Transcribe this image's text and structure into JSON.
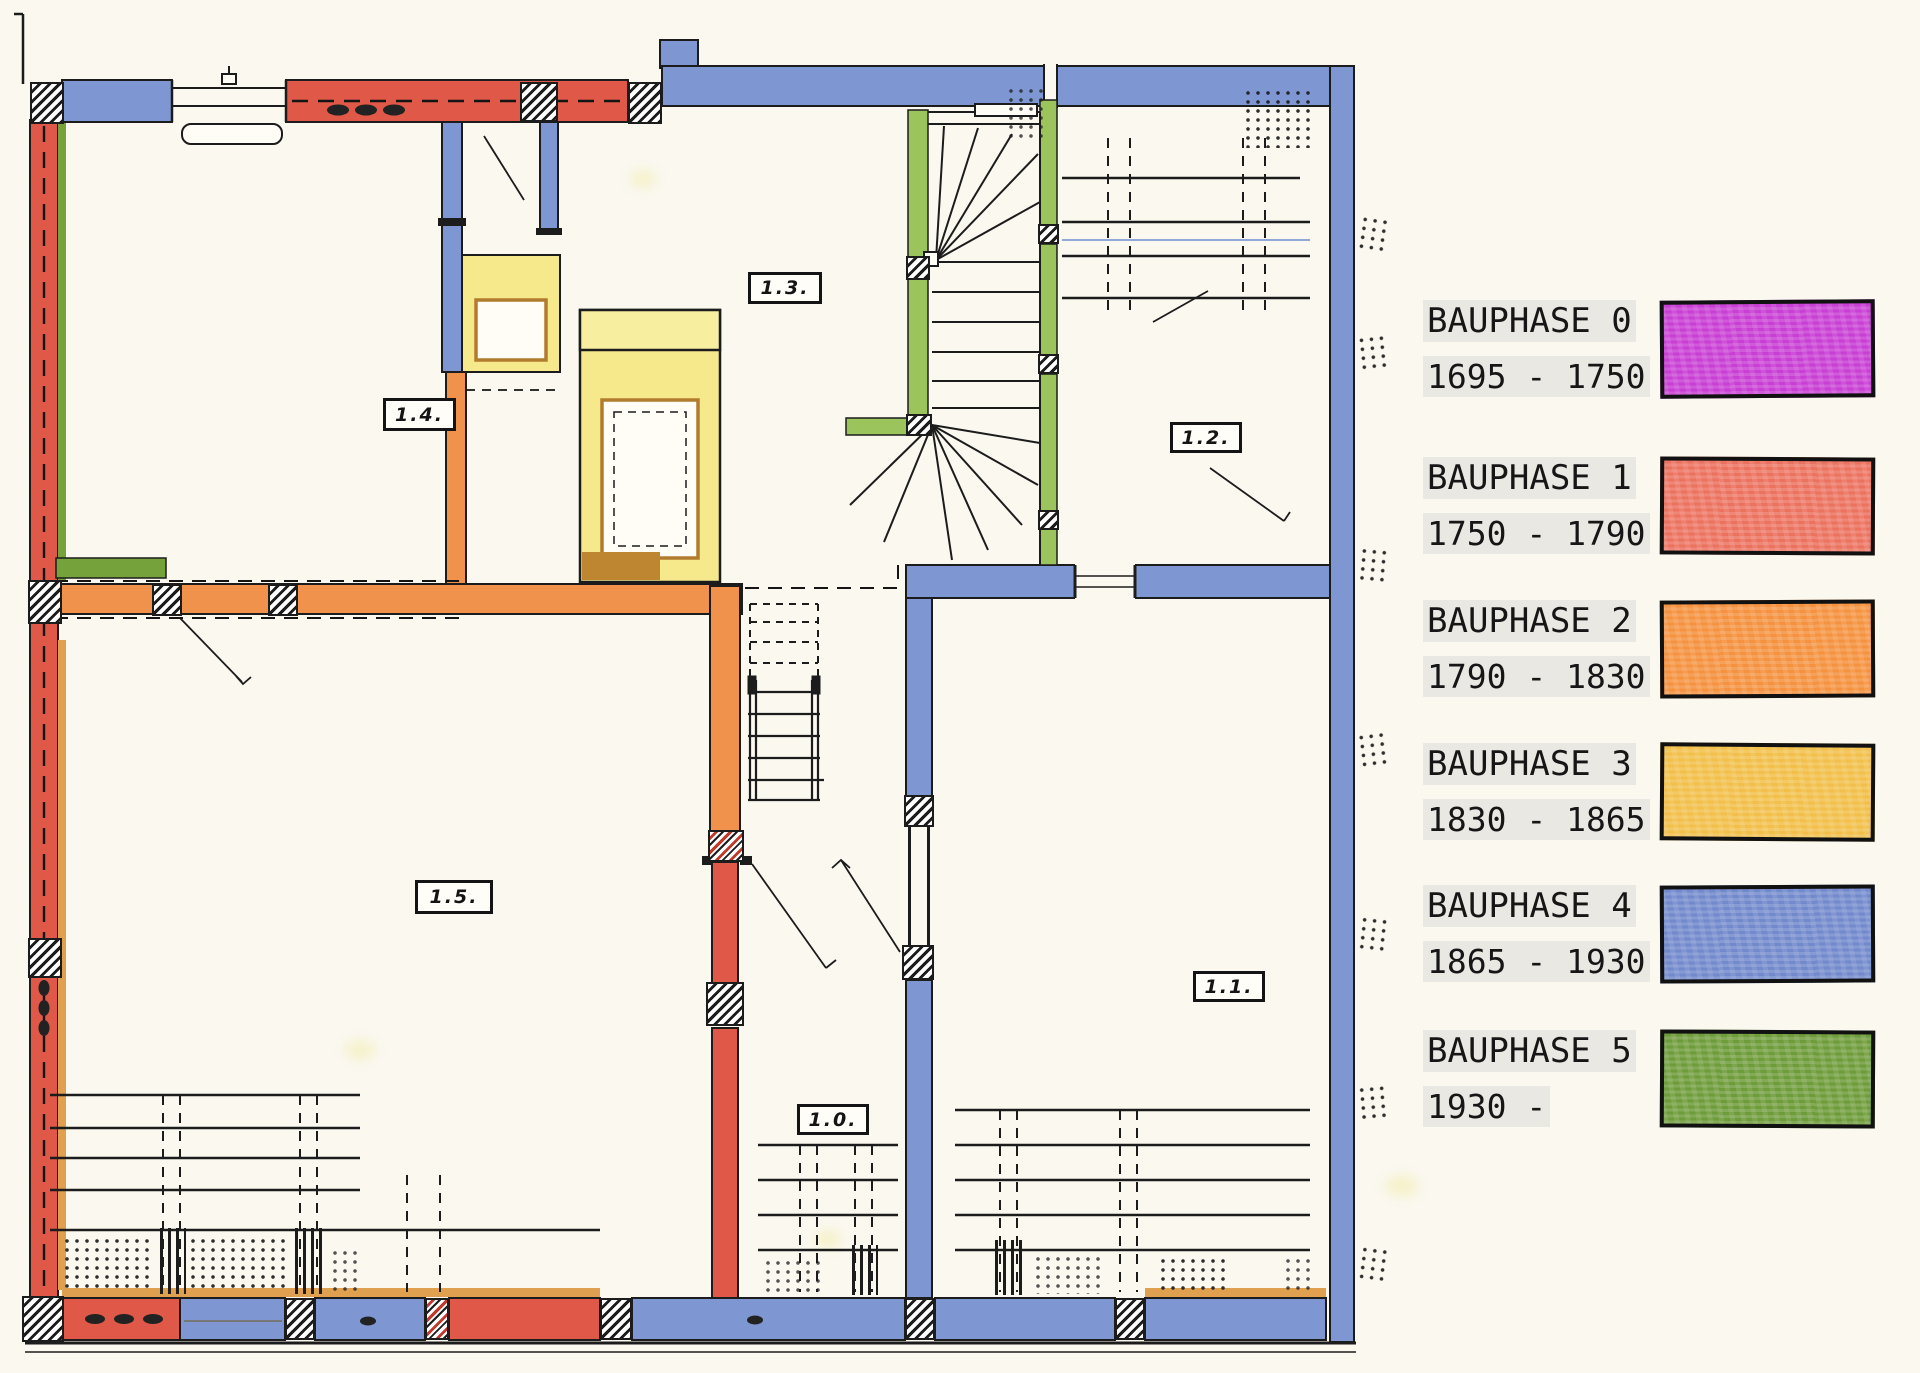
{
  "legend": {
    "items": [
      {
        "title": "BAUPHASE 0",
        "years": "1695 - 1750",
        "color": "#c83fd4"
      },
      {
        "title": "BAUPHASE 1",
        "years": "1750 - 1790",
        "color": "#ec7260"
      },
      {
        "title": "BAUPHASE 2",
        "years": "1790 - 1830",
        "color": "#f5923f"
      },
      {
        "title": "BAUPHASE 3",
        "years": "1830 - 1865",
        "color": "#f2c04a"
      },
      {
        "title": "BAUPHASE 4",
        "years": "1865 - 1930",
        "color": "#7289cc"
      },
      {
        "title": "BAUPHASE 5",
        "years": "1930 -",
        "color": "#6f9c3a"
      }
    ]
  },
  "plan": {
    "rooms": [
      {
        "label": "1.4."
      },
      {
        "label": "1.3."
      },
      {
        "label": "1.2."
      },
      {
        "label": "1.5."
      },
      {
        "label": "1.0."
      },
      {
        "label": "1.1."
      }
    ],
    "phase_colors": {
      "0": "#c83fd4",
      "1": "#df5848",
      "2": "#f0914c",
      "3": "#f6e98b",
      "4": "#7e97d3",
      "5": "#9cc45c",
      "5d": "#76a23c",
      "sill": "#dfa050",
      "brown": "#bf8631"
    }
  }
}
